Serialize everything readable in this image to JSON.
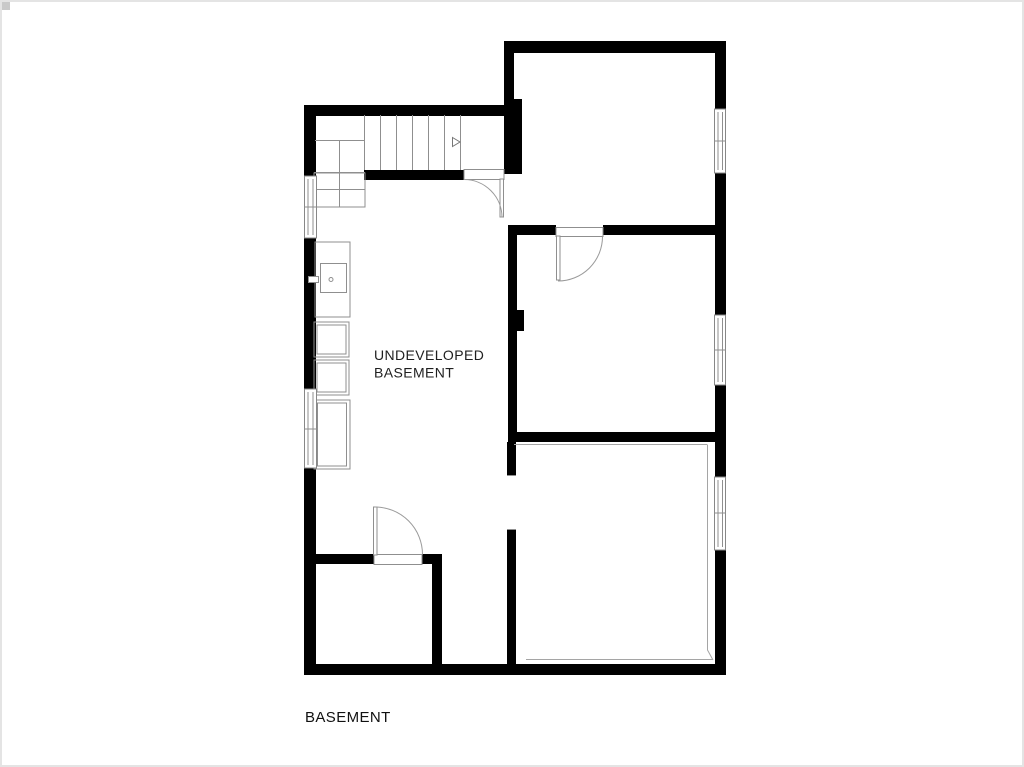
{
  "frame": {
    "background": "#ffffff",
    "border_color": "#e4e4e4",
    "corner_mark_color": "#c9c9c9"
  },
  "plan": {
    "title": "BASEMENT",
    "room_labels": [
      {
        "id": "undeveloped-basement",
        "line1": "UNDEVELOPED",
        "line2": "BASEMENT"
      }
    ],
    "colors": {
      "wall": "#000000",
      "thin_line": "#8f8f8f",
      "door_swing": "#9a9a9a",
      "window_line": "#878787",
      "text": "#1f1f1f"
    },
    "icons": [
      {
        "name": "stair-direction-arrow",
        "shape": "outlined-triangle"
      },
      {
        "name": "furnace-icon",
        "shape": "square-with-vent-and-dot"
      }
    ],
    "features": {
      "doors": 3,
      "windows": 5,
      "stair_treads": 7
    }
  }
}
